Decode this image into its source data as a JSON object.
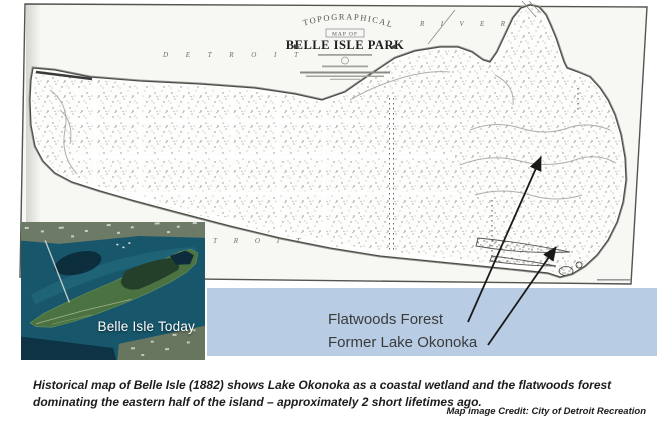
{
  "historical_map": {
    "title_arc": "TOPOGRAPHICAL",
    "title_mid": "MAP OF",
    "title_main": "BELLE ISLE PARK",
    "river_top_west": "D E T R O I T",
    "river_top_east": "R I V E R",
    "river_bottom_west": "D E T R O I T"
  },
  "inset": {
    "label": "Belle Isle Today"
  },
  "annotations": {
    "flatwoods_label": "Flatwoods Forest",
    "okonoka_label": "Former Lake Okonoka"
  },
  "caption": {
    "body": "Historical map of Belle Isle (1882) shows Lake Okonoka as a coastal wetland and the flatwoods forest dominating the eastern half of the island – approximately 2 short lifetimes ago.",
    "credit": "Map image Credit: City of Detroit Recreation"
  },
  "colors": {
    "band_blue": "#b8cce4",
    "map_paper": "#f7f7f4",
    "map_ink": "#4c4c48",
    "water_teal": "#17566b",
    "island_green": "#4b7342",
    "annotation_ink": "#1a1a1a"
  }
}
